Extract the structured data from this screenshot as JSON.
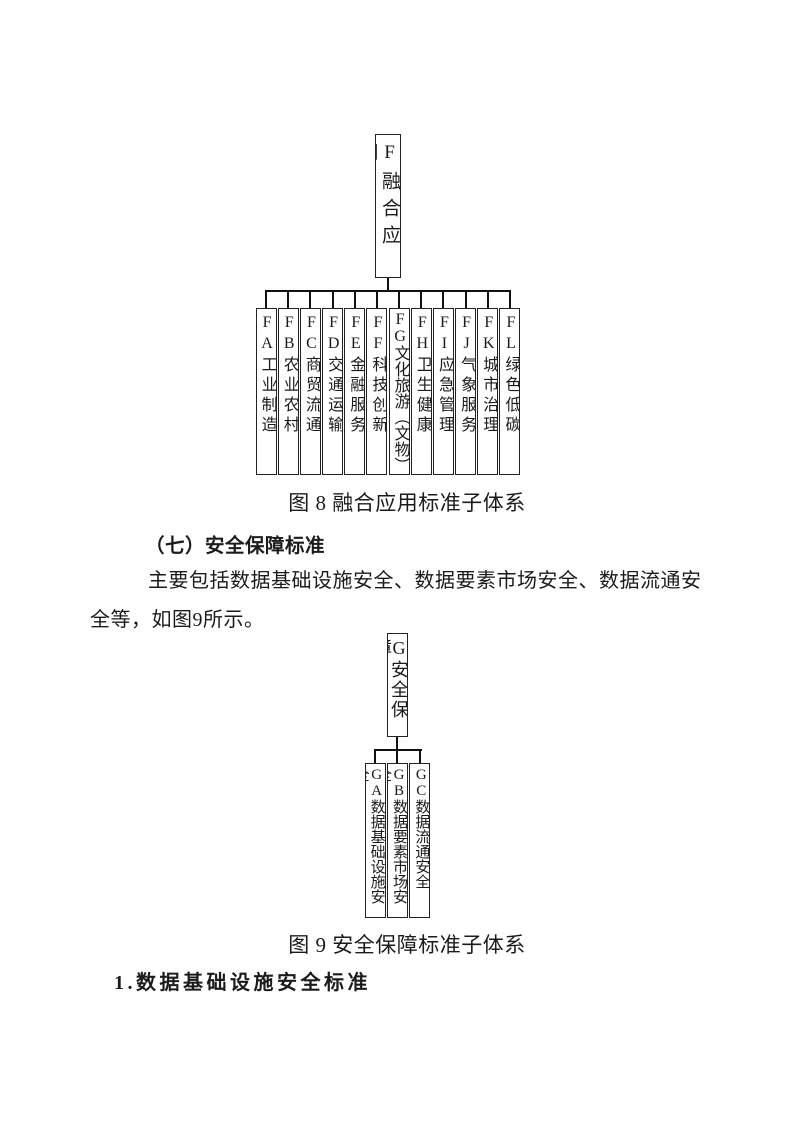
{
  "figure8": {
    "root": "F融合应用",
    "children": [
      "FA工业制造",
      "FB农业农村",
      "FC商贸流通",
      "FD交通运输",
      "FE金融服务",
      "FF科技创新",
      "FG文化旅游（文物）",
      "FH卫生健康",
      "FI应急管理",
      "FJ气象服务",
      "FK城市治理",
      "FL绿色低碳"
    ],
    "caption": "图 8 融合应用标准子体系"
  },
  "section": {
    "heading": "（七）安全保障标准",
    "paragraph_line1": "主要包括数据基础设施安全、数据要素市场安全、数据流通安",
    "paragraph_line2": "全等，如图9所示。"
  },
  "figure9": {
    "root": "G安全保障",
    "children": [
      "GA数据基础设施安全",
      "GB数据要素市场安全",
      "GC数据流通安全"
    ],
    "caption": "图 9 安全保障标准子体系"
  },
  "subsection": {
    "heading": "1.数据基础设施安全标准"
  }
}
